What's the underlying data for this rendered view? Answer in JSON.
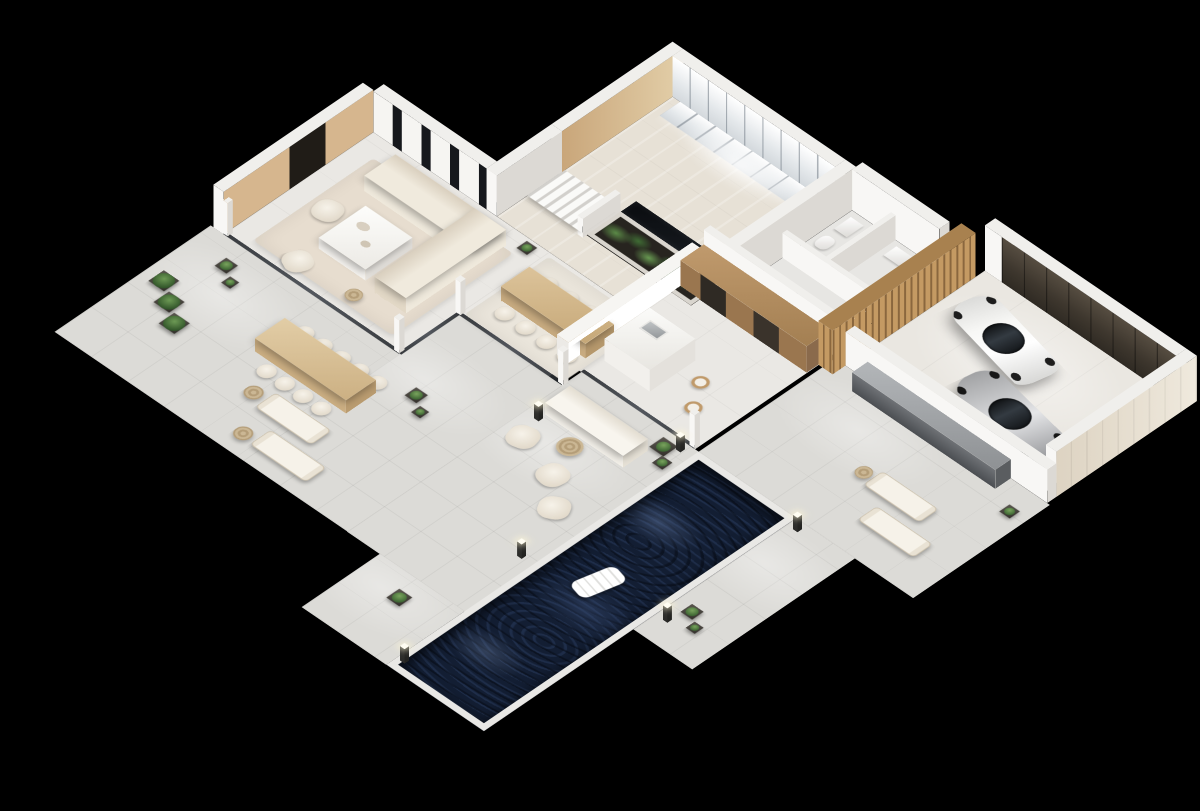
{
  "scene": {
    "type": "3d-isometric-floor-plan-render",
    "aria_label": "Isometric 3D floor plan render of a modern luxury villa on a black background, with pool terrace, garage and open-plan interior",
    "background_color": "#000000",
    "view": "isometric",
    "camera_rotation_deg": 45
  },
  "palette": {
    "background": "#000000",
    "wall_top": "#f0efec",
    "wall_face_light": "#f8f7f5",
    "wall_face_shade": "#dcd9d4",
    "interior_floor": "#eae8e4",
    "travertine": "#e7e1d6",
    "terrace_tile": "#dcdbd7",
    "wood_accent": "#c49a63",
    "cabinet_wood": "#a37f52",
    "garage_door": "#3e372e",
    "pool_water": "#131e33",
    "plant_green": "#4e7a42",
    "concrete_bar": "#8e9194",
    "car_white": "#f8f8f6",
    "car_silver": "#cfd0d2",
    "rug_beige": "#e7ddcf"
  },
  "rooms": {
    "entry_hall": {
      "label": "Entry hall with glass-front wardrobes, wood panel wall and ceiling light"
    },
    "laundry_bath": {
      "label": "Laundry room and bathroom block with washing machine and WC"
    },
    "garage": {
      "label": "Two-car garage with dark sectional door and wood slat accent wall"
    },
    "kitchen": {
      "label": "Kitchen with wood cabinetry, built-in appliances and stone island"
    },
    "atrium_garden": {
      "label": "Sunken planted garden atrium with floating staircase"
    },
    "dining": {
      "label": "Dining area with light wood table for eight"
    },
    "living": {
      "label": "Living room with L-shaped sectional sofa, coffee table and wood media wall"
    },
    "terrace": {
      "label": "Wrap-around stone pool terrace"
    },
    "pool": {
      "label": "Dark-tiled lap pool with white inflatable float"
    }
  },
  "objects": {
    "cars": [
      {
        "label": "White convertible sports car"
      },
      {
        "label": "Silver sports coupe"
      }
    ],
    "pool_float": {
      "label": "White inflatable pool float"
    },
    "stairs": {
      "label": "Floating staircase over garden atrium"
    },
    "outdoor_bar": {
      "label": "Concrete outdoor bar counter along garage wall"
    },
    "outdoor_lounge": {
      "label": "Outdoor lounge set: sofa, two chairs, rattan table"
    },
    "washer": {
      "label": "Front-load washing machine"
    },
    "counts": {
      "sun_loungers": 4,
      "dining_chairs": 8,
      "outdoor_dining_chairs": 9,
      "bar_stools": 2,
      "bollard_lights": 6,
      "cactus_planters": 13
    }
  }
}
